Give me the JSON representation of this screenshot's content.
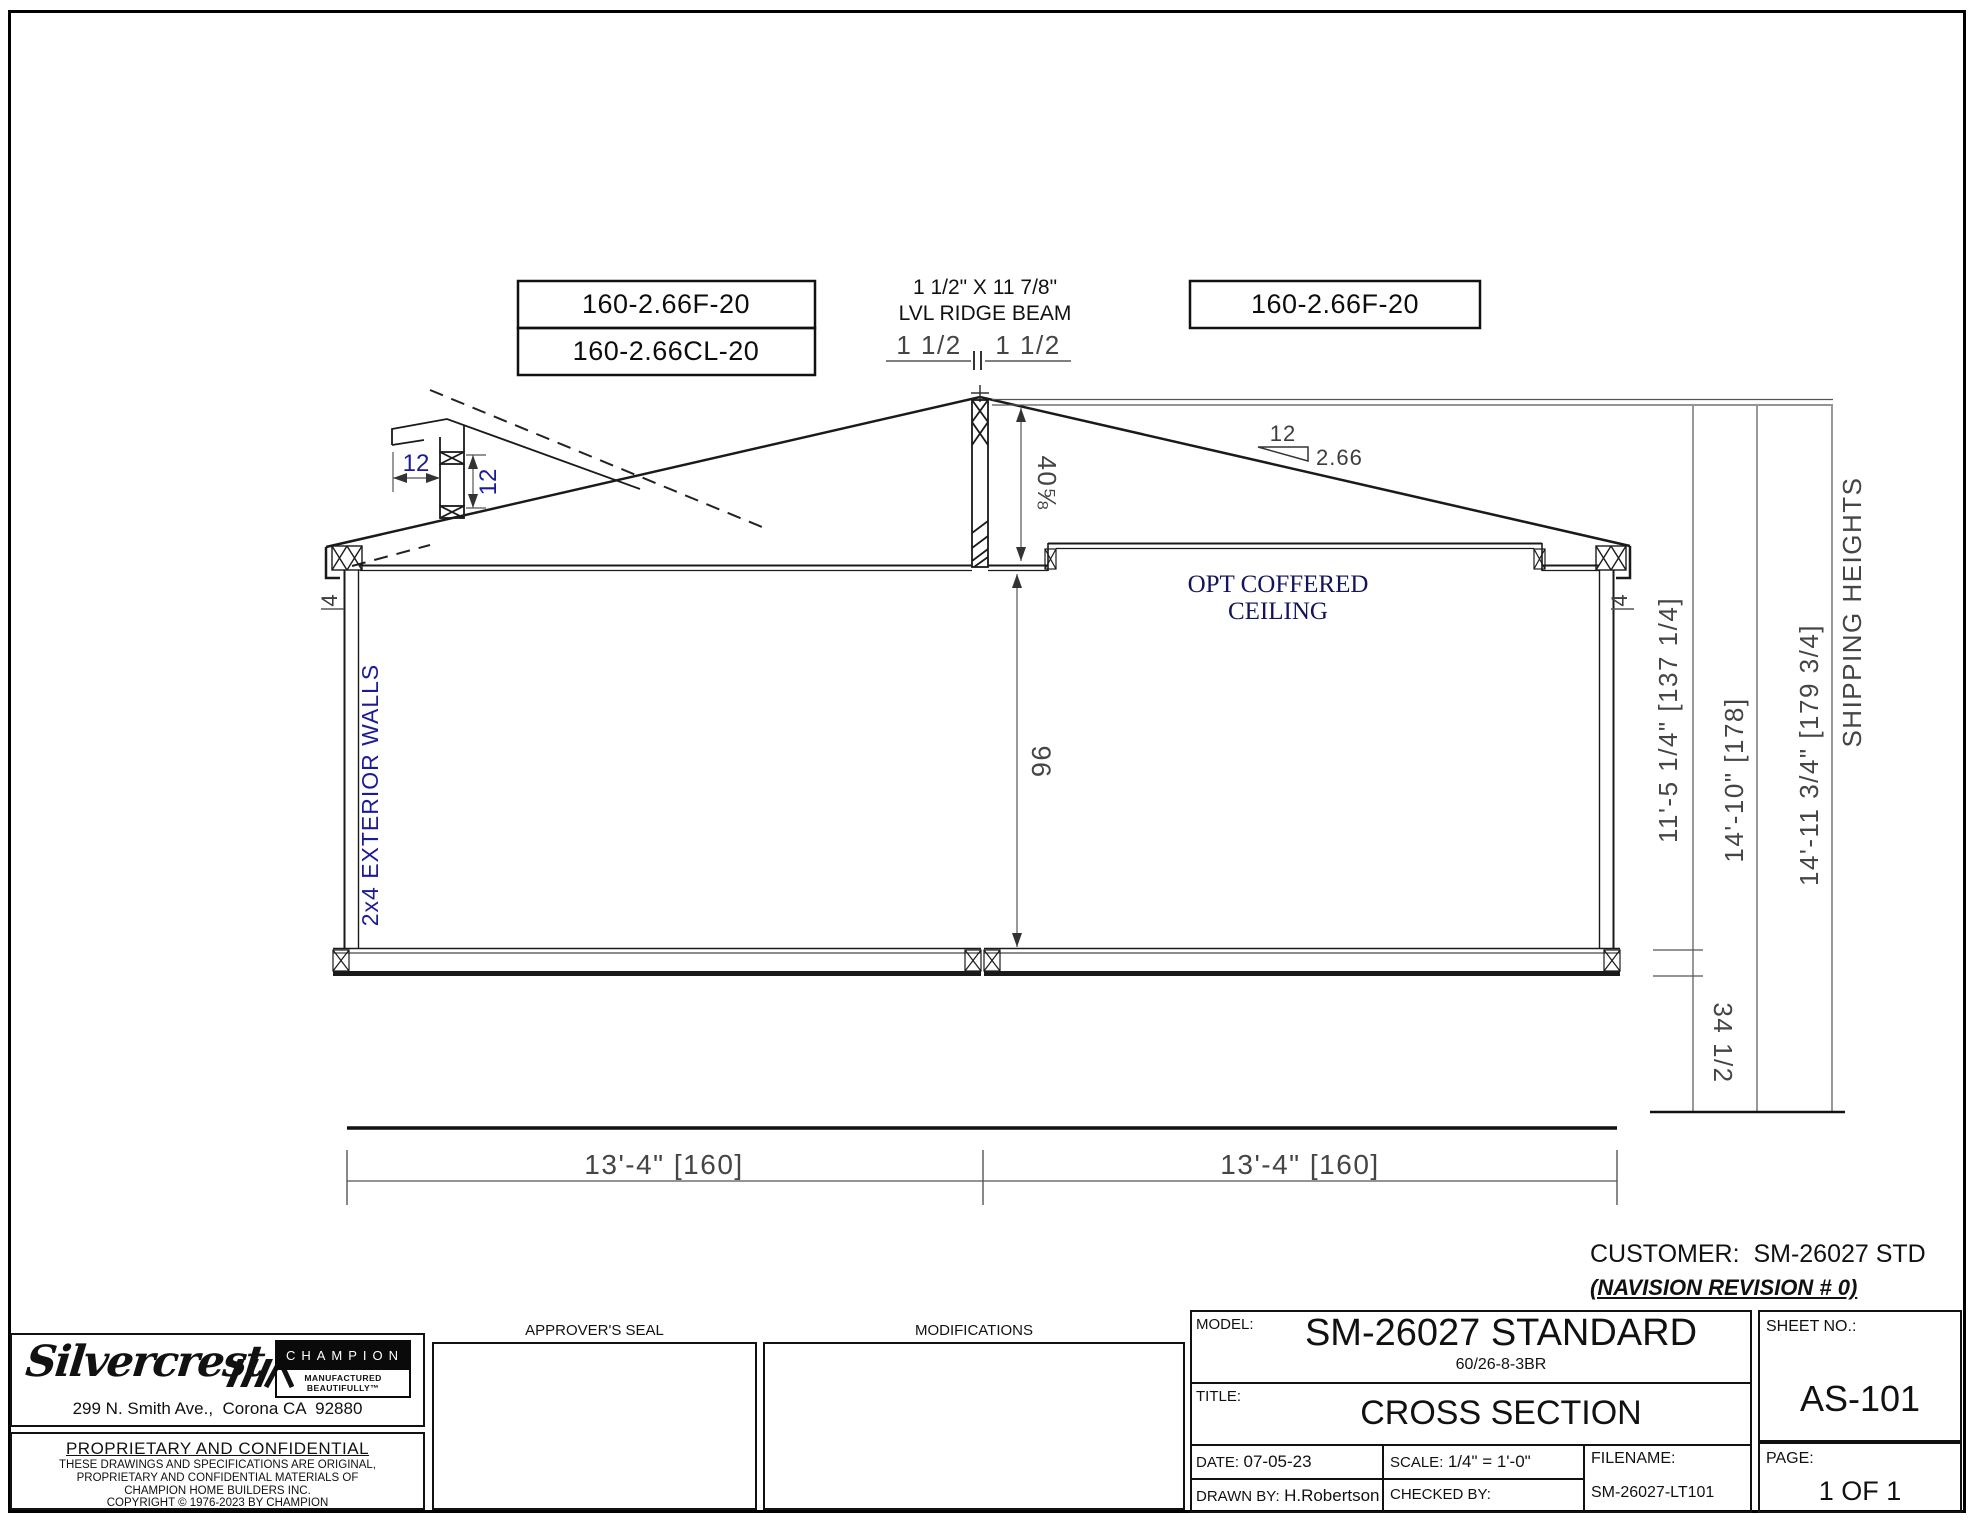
{
  "drawing": {
    "boxed_labels": [
      "160-2.66F-20",
      "160-2.66CL-20",
      "160-2.66F-20"
    ],
    "ridge_note_line1": "1 1/2\" X 11 7/8\"",
    "ridge_note_line2": "LVL RIDGE BEAM",
    "ridge_dim_left": "1 1/2",
    "ridge_dim_right": "1 1/2",
    "eave_dim_h": "12",
    "eave_dim_v": "12",
    "slope_rise": "12",
    "slope_run": "2.66",
    "peak_height_dim": "40⅝",
    "wall_height_dim": "96",
    "wall_thickness_left": "4",
    "wall_thickness_right": "4",
    "exterior_wall_label": "2x4 EXTERIOR WALLS",
    "coffered_line1": "OPT COFFERED",
    "coffered_line2": "CEILING",
    "dim_width_left": "13'-4\" [160]",
    "dim_width_right": "13'-4\" [160]",
    "dim_interior_height": "11'-5 1/4\" [137 1/4]",
    "dim_overall_height": "14'-10\" [178]",
    "dim_shipping_height": "14'-11 3/4\" [179 3/4]",
    "shipping_heights_label": "SHIPPING HEIGHTS",
    "dim_floor_height": "34 1/2"
  },
  "customer": {
    "line1": "CUSTOMER:  SM-26027 STD",
    "line2": "(NAVISION REVISION # 0)"
  },
  "title_block": {
    "logo": {
      "brand": "Silvercrest",
      "champion": "CHAMPION",
      "champion_tag": "MANUFACTURED BEAUTIFULLY™",
      "address": "299 N. Smith Ave.,  Corona CA  92880"
    },
    "proprietary": {
      "heading": "PROPRIETARY AND CONFIDENTIAL",
      "lines": [
        "THESE DRAWINGS AND SPECIFICATIONS ARE ORIGINAL,",
        "PROPRIETARY AND CONFIDENTIAL MATERIALS OF",
        "CHAMPION HOME BUILDERS INC.",
        "COPYRIGHT © 1976-2023 BY CHAMPION"
      ]
    },
    "approver_seal_label": "APPROVER'S SEAL",
    "modifications_label": "MODIFICATIONS",
    "model_label": "MODEL:",
    "model": "SM-26027 STANDARD",
    "model_sub": "60/26-8-3BR",
    "title_label": "TITLE:",
    "title": "CROSS SECTION",
    "sheet_label": "SHEET NO.:",
    "sheet": "AS-101",
    "date_label": "DATE:",
    "date": "07-05-23",
    "scale_label": "SCALE:",
    "scale": "1/4\" = 1'-0\"",
    "drawn_label": "DRAWN BY:",
    "drawn": "H.Robertson",
    "checked_label": "CHECKED BY:",
    "filename_label": "FILENAME:",
    "filename": "SM-26027-LT101",
    "page_label": "PAGE:",
    "page": "1 OF 1"
  }
}
